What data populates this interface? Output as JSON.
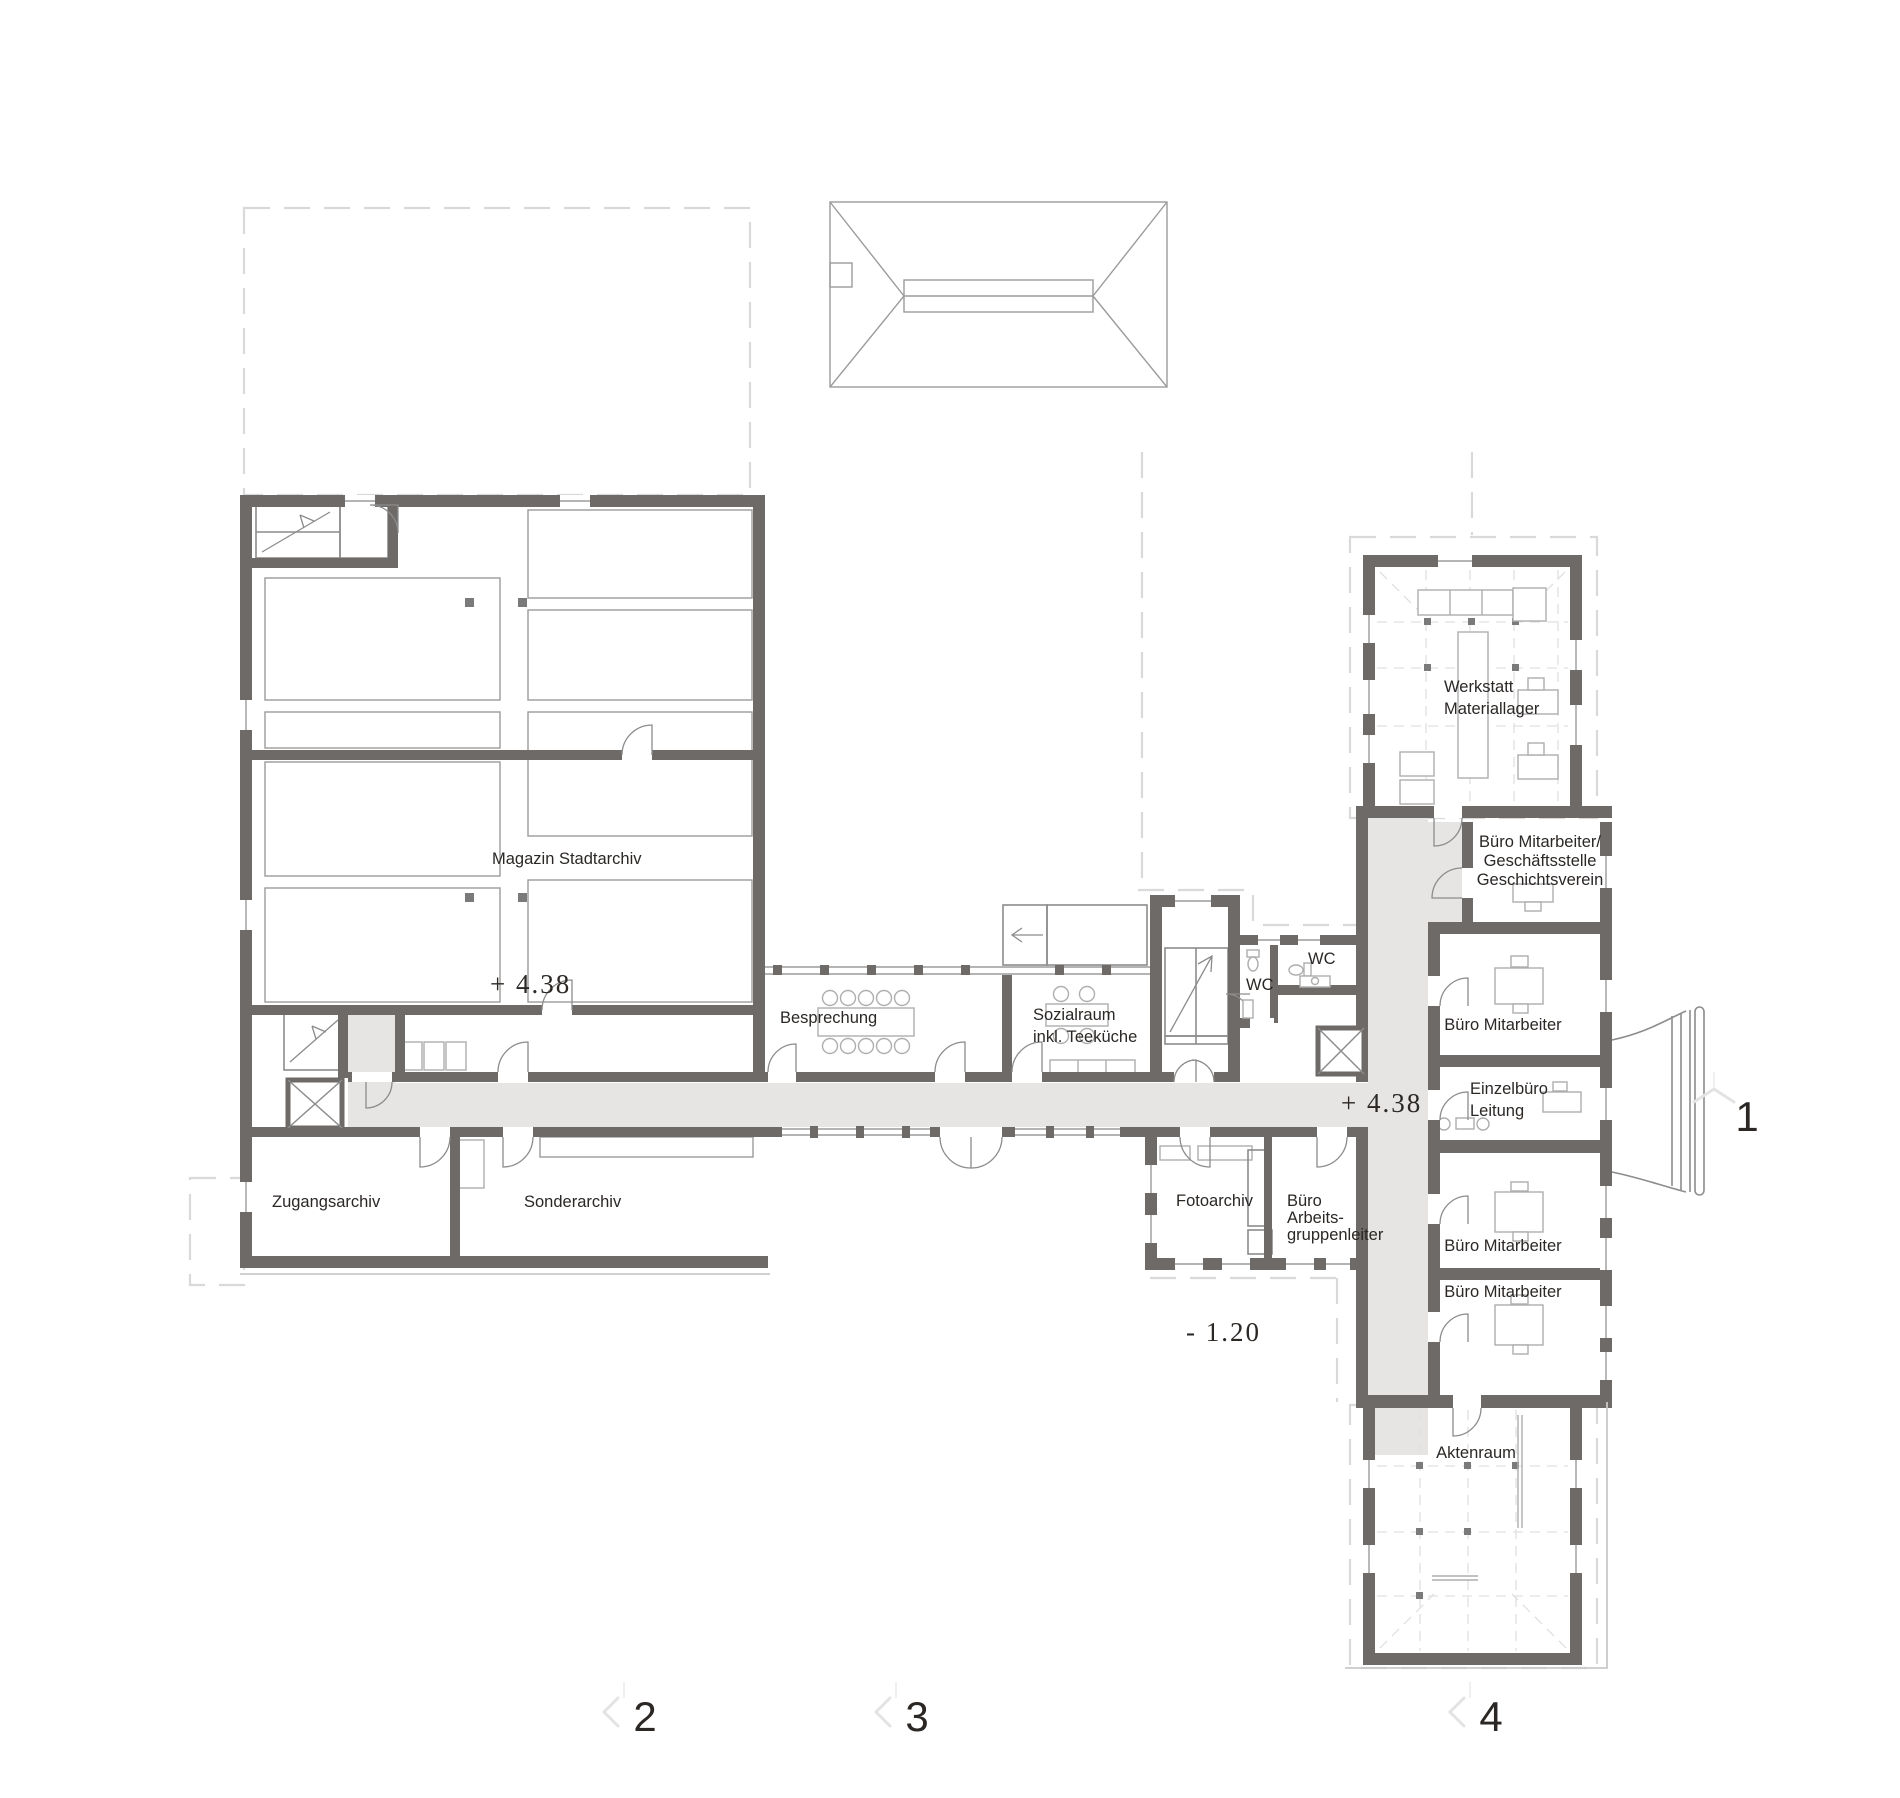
{
  "colors": {
    "wall": "#6e6a67",
    "corridor_fill": "#e6e5e3",
    "line": "#8c8c8c",
    "furniture": "#aeaeae",
    "ghost_dashed": "#d9d9d9",
    "text": "#2b2725"
  },
  "labels": {
    "magazin": "Magazin Stadtarchiv",
    "level_magazin": "+ 4.38",
    "besprechung": "Besprechung",
    "sozialraum_line1": "Sozialraum",
    "sozialraum_line2": "inkl. Teeküche",
    "wc_left": "WC",
    "wc_right": "WC",
    "werkstatt_line1": "Werkstatt",
    "werkstatt_line2": "Materiallager",
    "buero_gs_line1": "Büro Mitarbeiter/",
    "buero_gs_line2": "Geschäftsstelle",
    "buero_gs_line3": "Geschichtsverein",
    "buero_m1": "Büro Mitarbeiter",
    "einzelbuero_line1": "Einzelbüro",
    "einzelbuero_line2": "Leitung",
    "level_corridor": "+ 4.38",
    "buero_m2": "Büro Mitarbeiter",
    "buero_m3": "Büro Mitarbeiter",
    "aktenraum": "Aktenraum",
    "fotoarchiv": "Fotoarchiv",
    "buero_agl_line1": "Büro",
    "buero_agl_line2": "Arbeits-",
    "buero_agl_line3": "gruppenleiter",
    "zugangsarchiv": "Zugangsarchiv",
    "sonderarchiv": "Sonderarchiv",
    "level_lower": "- 1.20"
  },
  "axis_markers": {
    "axis_1": "1",
    "axis_2": "2",
    "axis_3": "3",
    "axis_4": "4"
  }
}
